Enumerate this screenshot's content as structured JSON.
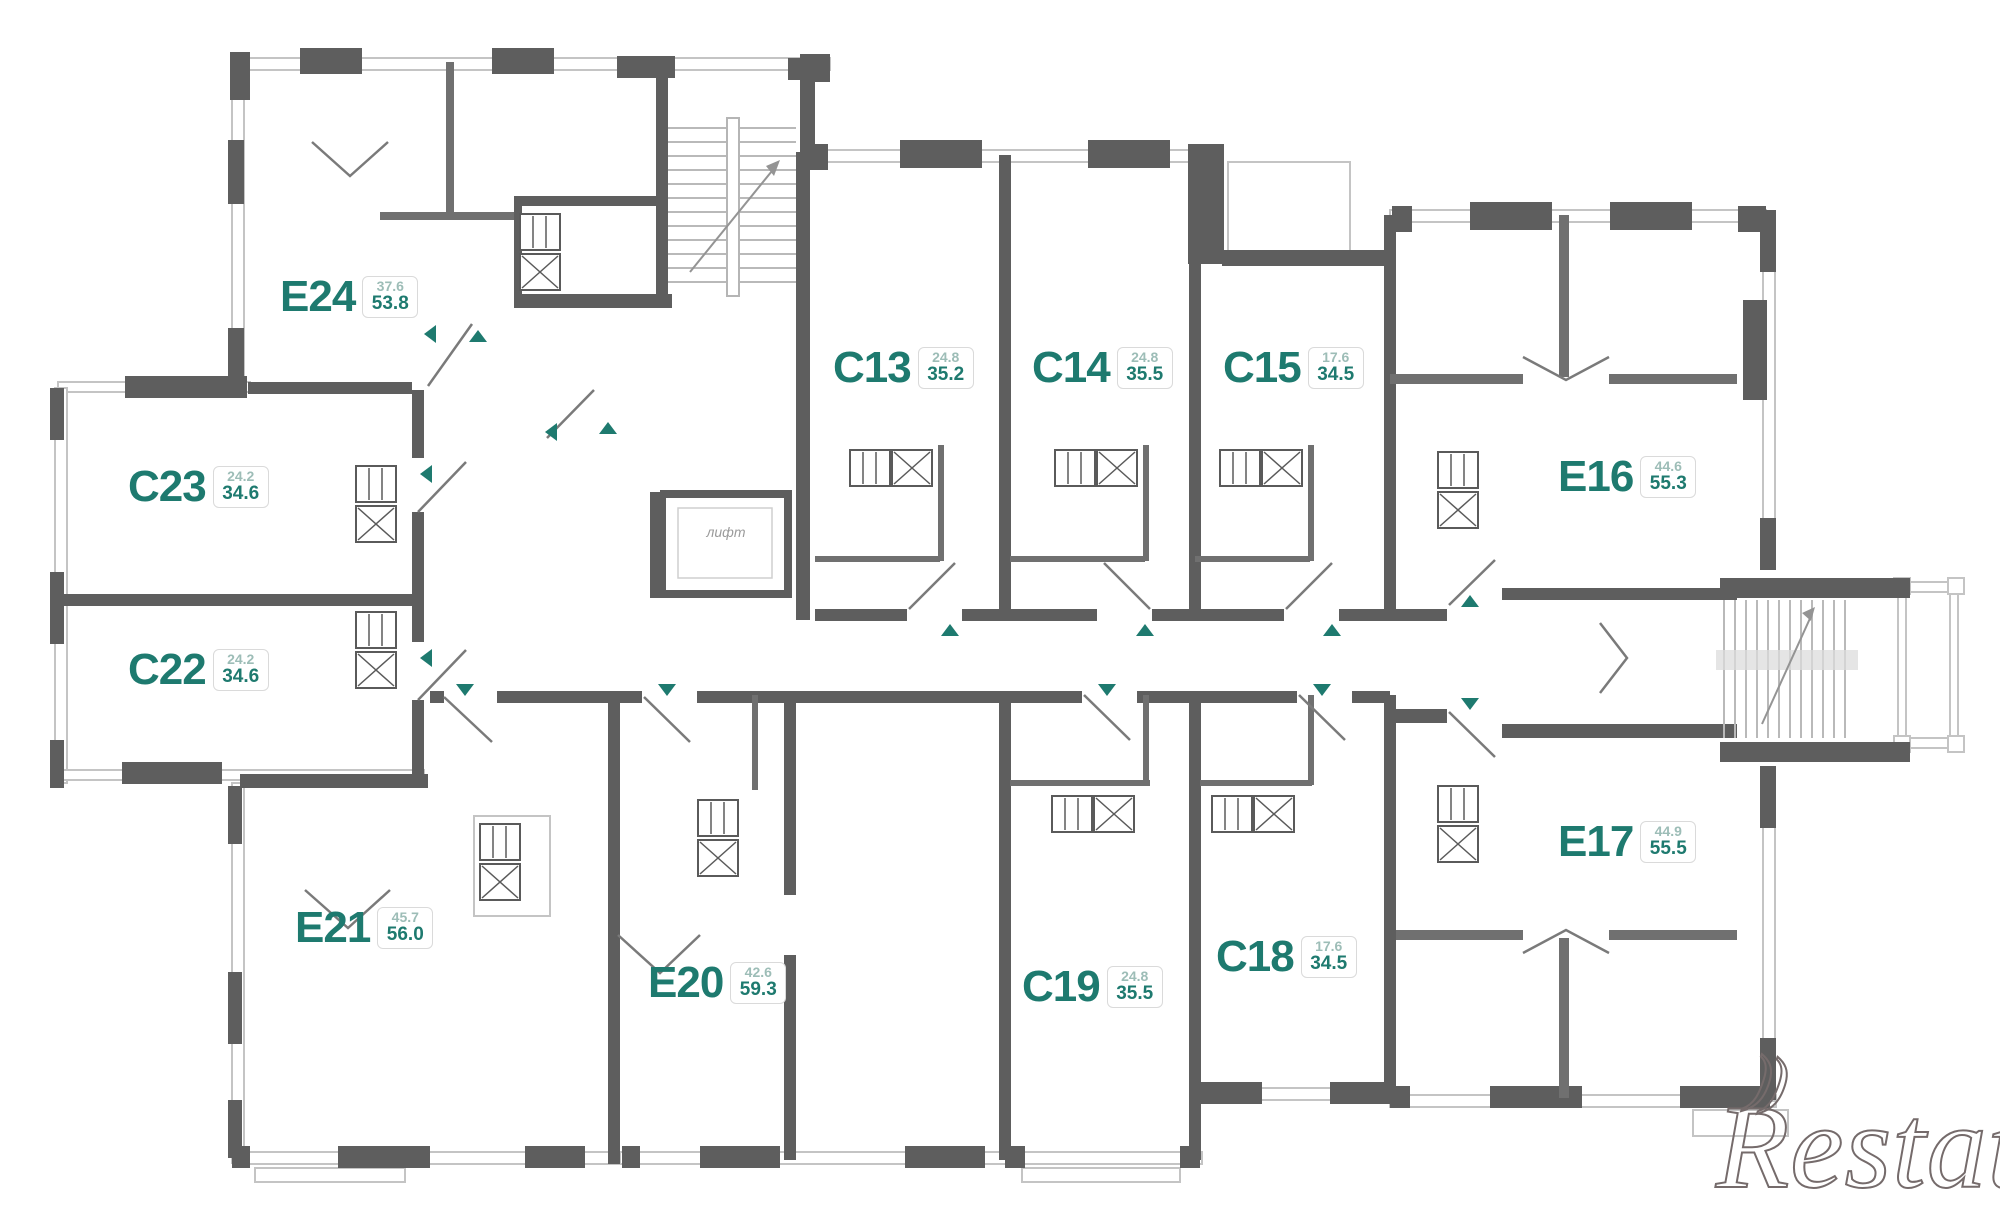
{
  "plan": {
    "title": "Residential floor plan",
    "elevator_label": "лифт",
    "watermark": "Restate",
    "watermark_swash": "))",
    "colors": {
      "wall": "#5e5e5e",
      "label_teal": "#1e7a6f",
      "area_light": "#9dbdb7",
      "window_line": "#c4c4c4"
    },
    "units": [
      {
        "id": "E24",
        "area_top": "37.6",
        "area_total": "53.8",
        "x": 280,
        "y": 272
      },
      {
        "id": "C23",
        "area_top": "24.2",
        "area_total": "34.6",
        "x": 128,
        "y": 462
      },
      {
        "id": "C22",
        "area_top": "24.2",
        "area_total": "34.6",
        "x": 128,
        "y": 645
      },
      {
        "id": "E21",
        "area_top": "45.7",
        "area_total": "56.0",
        "x": 295,
        "y": 903
      },
      {
        "id": "E20",
        "area_top": "42.6",
        "area_total": "59.3",
        "x": 648,
        "y": 958
      },
      {
        "id": "C13",
        "area_top": "24.8",
        "area_total": "35.2",
        "x": 833,
        "y": 343
      },
      {
        "id": "C14",
        "area_top": "24.8",
        "area_total": "35.5",
        "x": 1032,
        "y": 343
      },
      {
        "id": "C15",
        "area_top": "17.6",
        "area_total": "34.5",
        "x": 1223,
        "y": 343
      },
      {
        "id": "E16",
        "area_top": "44.6",
        "area_total": "55.3",
        "x": 1558,
        "y": 452
      },
      {
        "id": "E17",
        "area_top": "44.9",
        "area_total": "55.5",
        "x": 1558,
        "y": 817
      },
      {
        "id": "C18",
        "area_top": "17.6",
        "area_total": "34.5",
        "x": 1216,
        "y": 932
      },
      {
        "id": "C19",
        "area_top": "24.8",
        "area_total": "35.5",
        "x": 1022,
        "y": 962
      }
    ]
  }
}
